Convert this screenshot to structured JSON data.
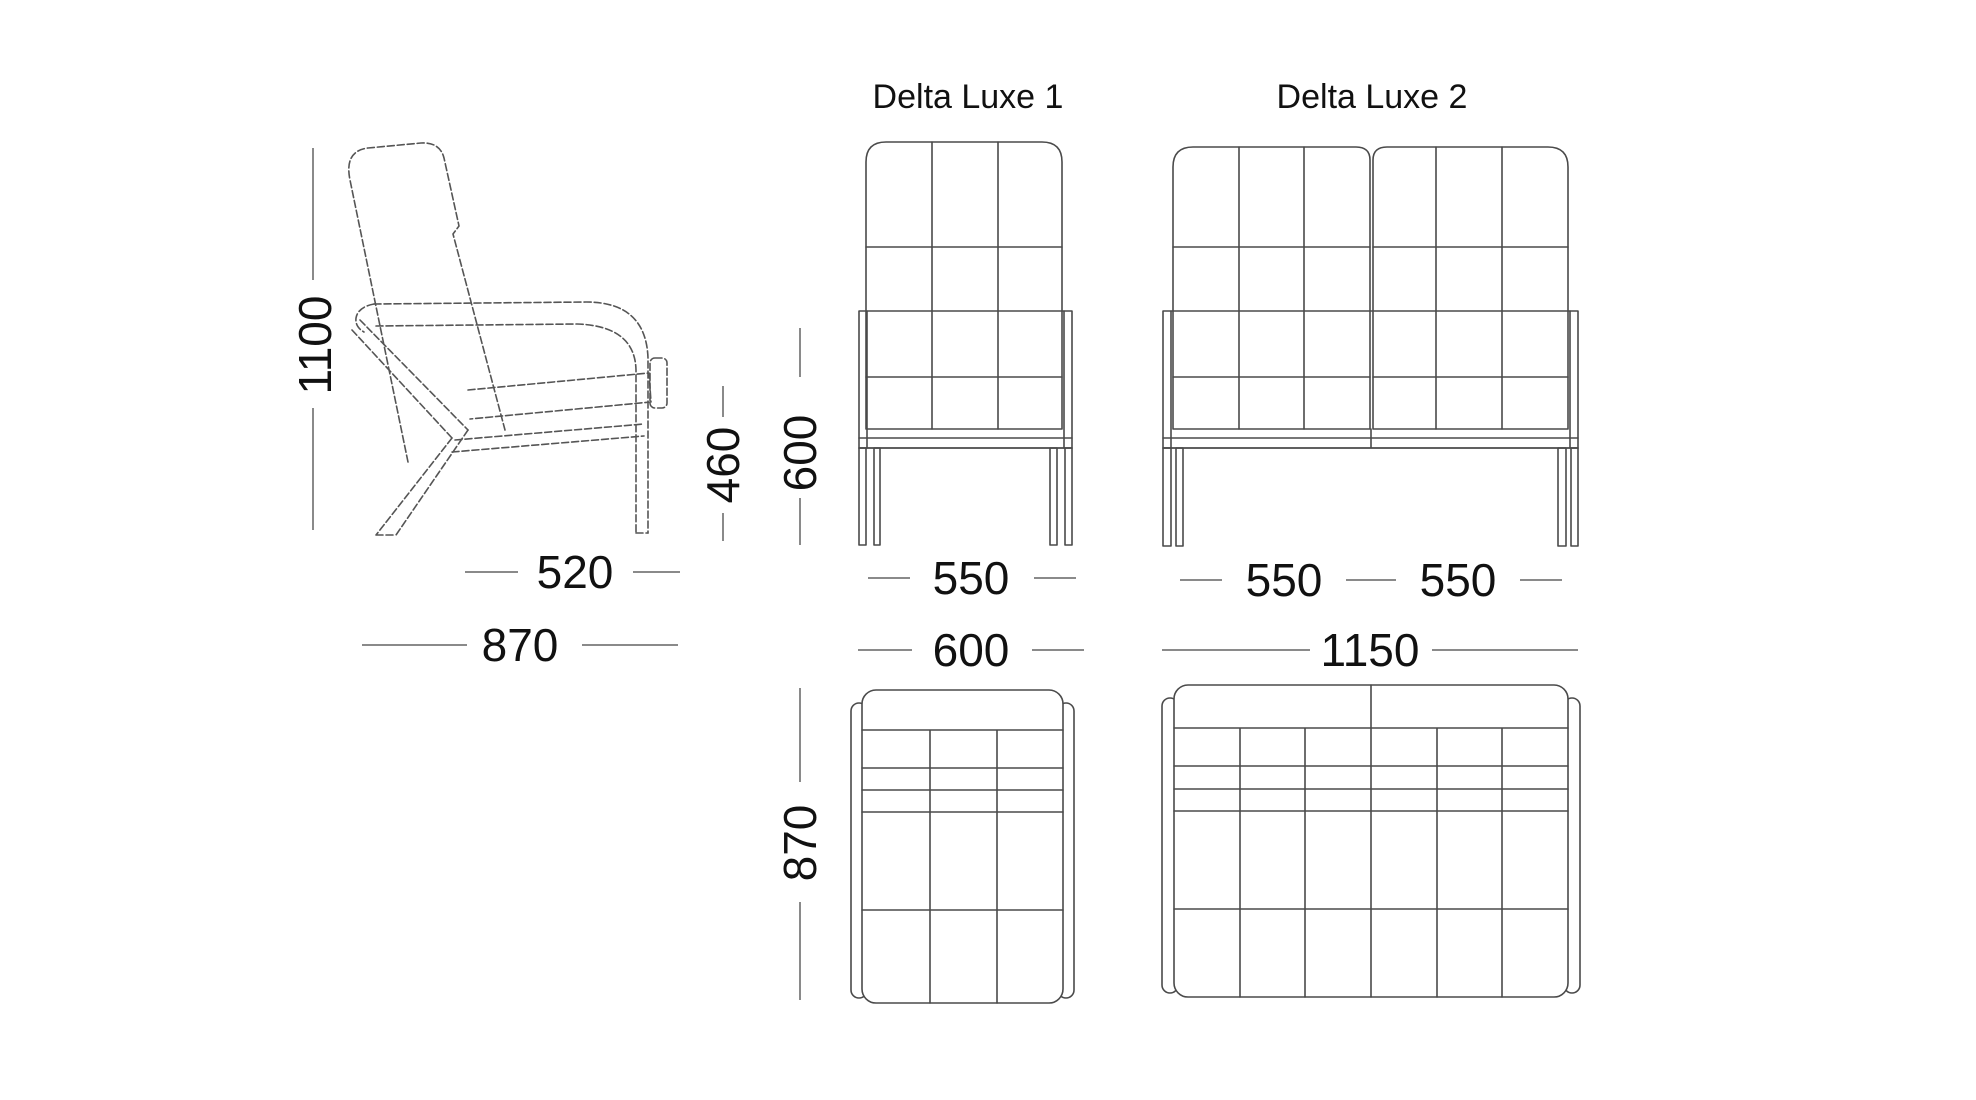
{
  "colors": {
    "background": "#ffffff",
    "drawing_line": "#4a4a4a",
    "dimension_line": "#8a8a8a",
    "text": "#111111"
  },
  "products": {
    "model_1": {
      "title": "Delta Luxe 1"
    },
    "model_2": {
      "title": "Delta Luxe 2"
    }
  },
  "side_view": {
    "height": "1100",
    "seat_height": "460",
    "seat_depth": "520",
    "depth": "870"
  },
  "model1_front": {
    "back_height": "600",
    "seat_width": "550"
  },
  "model2_front": {
    "seat_width_left": "550",
    "seat_width_right": "550"
  },
  "model1_top": {
    "width": "600",
    "depth": "870"
  },
  "model2_top": {
    "width": "1150"
  }
}
